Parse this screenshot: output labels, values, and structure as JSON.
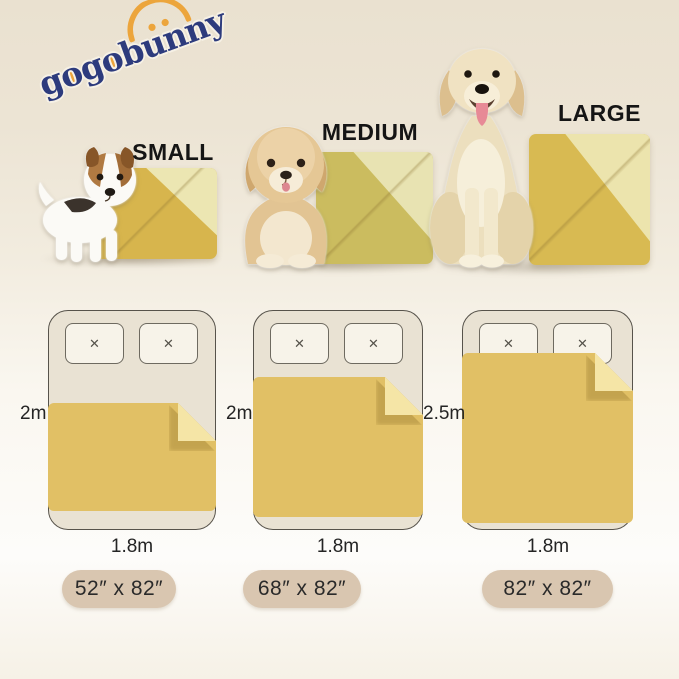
{
  "logo": {
    "text": "gogobunny",
    "navy": "#2d3b7d",
    "orange": "#eca53c"
  },
  "products": [
    {
      "label": "SMALL",
      "dog": "jack-russell-puppy",
      "blanket_color": "#d7b54d",
      "fold_color": "#ece6b2"
    },
    {
      "label": "MEDIUM",
      "dog": "fluffy-cream-puppy",
      "blanket_color": "#cbbc5f",
      "fold_color": "#e8e3b2"
    },
    {
      "label": "LARGE",
      "dog": "golden-retriever",
      "blanket_color": "#d8ba52",
      "fold_color": "#ece4ad"
    }
  ],
  "bed_diagrams": [
    {
      "height_label": "2m",
      "width_label": "1.8m"
    },
    {
      "height_label": "2m",
      "width_label": "1.8m"
    },
    {
      "height_label": "2.5m",
      "width_label": "1.8m"
    }
  ],
  "size_pills": [
    {
      "label": "52″ x 82″"
    },
    {
      "label": "68″ x 82″"
    },
    {
      "label": "82″ x 82″"
    }
  ],
  "icons": {
    "pillow_stitch": "✕"
  },
  "colors": {
    "background_top": "#eae1d0",
    "background_bottom": "#fdfcfa",
    "bed_fill": "#e9e2d3",
    "bed_border": "#57534b",
    "pillow_fill": "#f7f3e9",
    "diagram_blanket": "#e1c065",
    "diagram_fold": "#f5e5a6",
    "pill_fill": "#d9c6b0",
    "label_text": "#151515"
  }
}
